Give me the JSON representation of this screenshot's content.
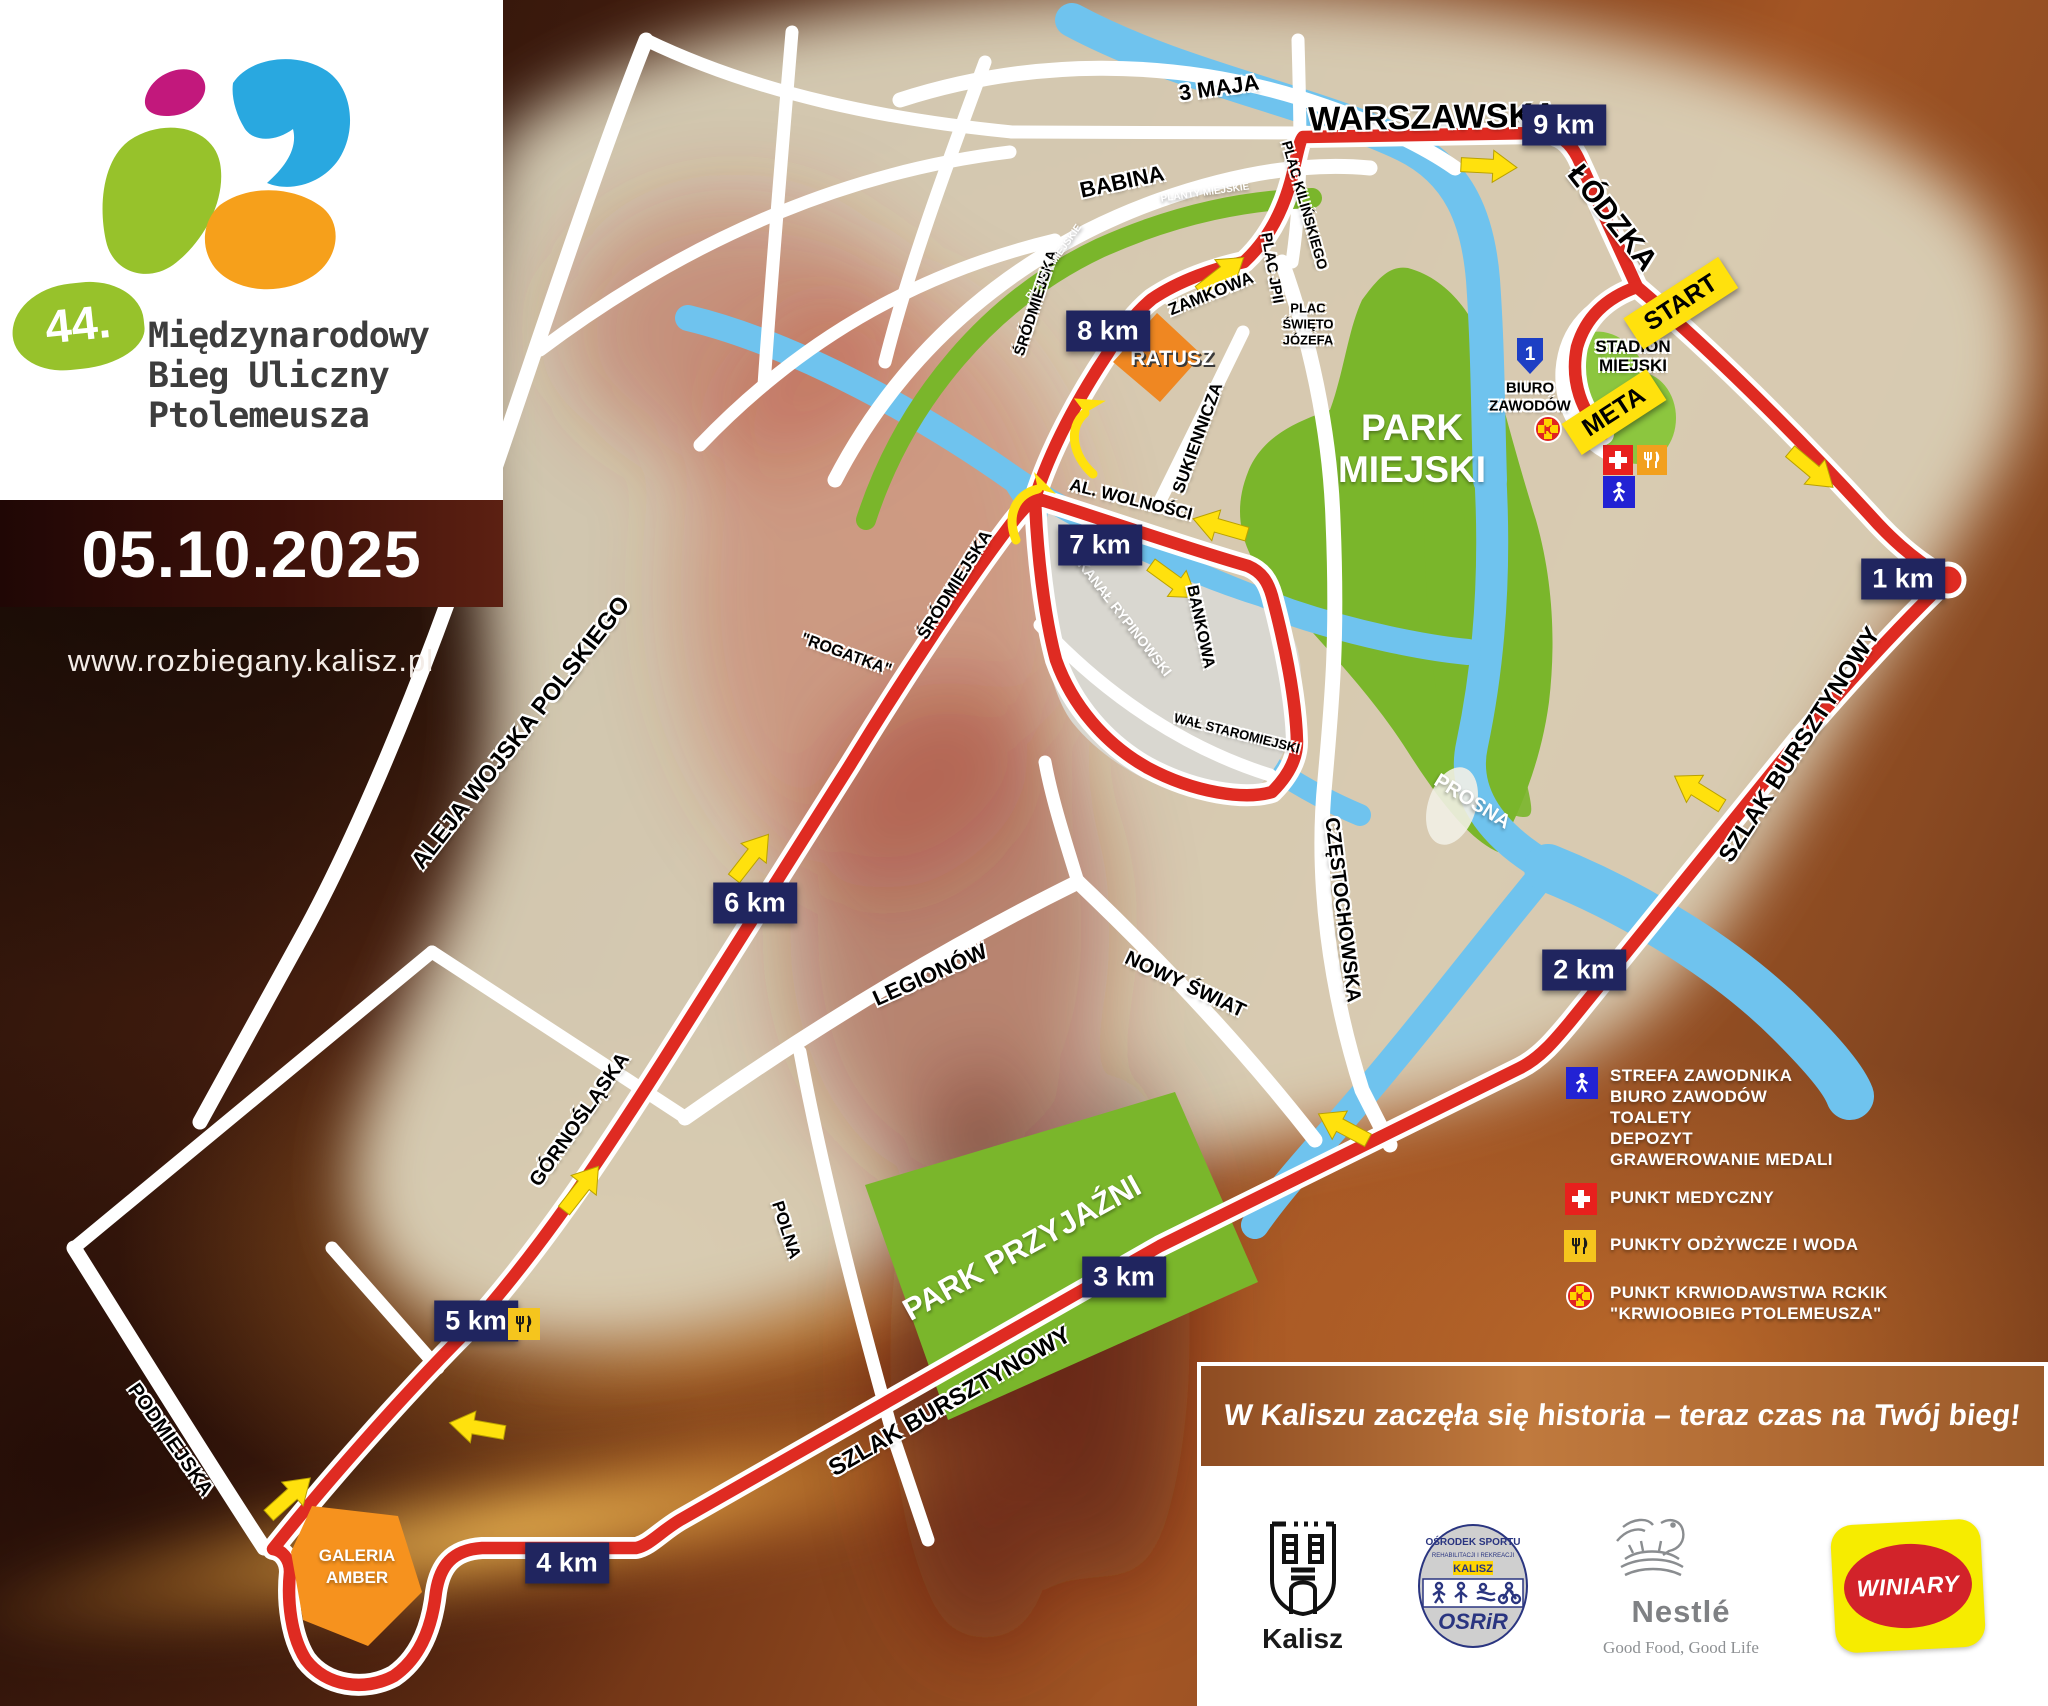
{
  "event": {
    "edition": "44.",
    "title1": "Międzynarodowy",
    "title2": "Bieg Uliczny",
    "title3": "Ptolemeusza",
    "date": "05.10.2025",
    "website": "www.rozbiegany.kalisz.pl"
  },
  "km": {
    "k1": "1 km",
    "k2": "2 km",
    "k3": "3 km",
    "k4": "4 km",
    "k5": "5 km",
    "k6": "6 km",
    "k7": "7 km",
    "k8": "8 km",
    "k9": "9 km"
  },
  "route": {
    "start": "START",
    "meta": "META"
  },
  "places": {
    "ratusz": "RATUSZ",
    "galeria1": "GALERIA",
    "galeria2": "AMBER",
    "stadion1": "STADION",
    "stadion2": "MIEJSKI",
    "biuro_no": "1",
    "biuro1": "BIURO",
    "biuro2": "ZAWODÓW",
    "park_m1": "PARK",
    "park_m2": "MIEJSKI",
    "park_p": "PARK PRZYJAŹNI"
  },
  "streets": {
    "warszawska": "WARSZAWSKA",
    "lodzka": "ŁÓDZKA",
    "maja": "3 MAJA",
    "babina": "BABINA",
    "zamkowa": "ZAMKOWA",
    "kilinskiego": "PLAC KILIŃSKIEGO",
    "jp2": "PLAC JPII",
    "jozefa1": "PLAC",
    "jozefa2": "ŚWIĘTO",
    "jozefa3": "JÓZEFA",
    "sukiennicza": "SUKIENNICZA",
    "srodmiejska": "ŚRÓDMIEJSKA",
    "wolnosci": "AL. WOLNOŚCI",
    "bankowa": "BANKOWA",
    "wal": "WAŁ STAROMIEJSKI",
    "czestochowska": "CZĘSTOCHOWSKA",
    "nowy_swiat": "NOWY ŚWIAT",
    "legionow": "LEGIONÓW",
    "rogatka": "\"ROGATKA\"",
    "wojska": "ALEJA WOJSKA POLSKIEGO",
    "gornoslaska": "GÓRNOŚLĄSKA",
    "polna": "POLNA",
    "podmiejska": "PODMIEJSKA",
    "szlak": "SZLAK BURSZTYNOWY",
    "planty": "PLANTY MIEJSKIE"
  },
  "waters": {
    "prosna": "PROSNA",
    "kanal": "KANAŁ RYPINOWSKI"
  },
  "legend": {
    "strefa": [
      "STREFA ZAWODNIKA",
      "BIURO ZAWODÓW",
      "TOALETY",
      "DEPOZYT",
      "GRAWEROWANIE MEDALI"
    ],
    "medyczny": "PUNKT MEDYCZNY",
    "odzywcze": "PUNKTY ODŻYWCZE I WODA",
    "krwio1": "PUNKT KRWIODAWSTWA RCKIK",
    "krwio2": "\"KRWIOOBIEG PTOLEMEUSZA\""
  },
  "banner": "W Kaliszu zaczęła się historia – teraz czas na Twój bieg!",
  "sponsors": {
    "kalisz": "Kalisz",
    "osrir_top": "OŚRODEK SPORTU",
    "osrir_mid": "REHABILITACJI I REKREACJI",
    "osrir_city": "KALISZ",
    "osrir": "OSRiR",
    "nestle": "Nestlé",
    "nestle_tag": "Good Food, Good Life",
    "winiary": "WINIARY"
  }
}
